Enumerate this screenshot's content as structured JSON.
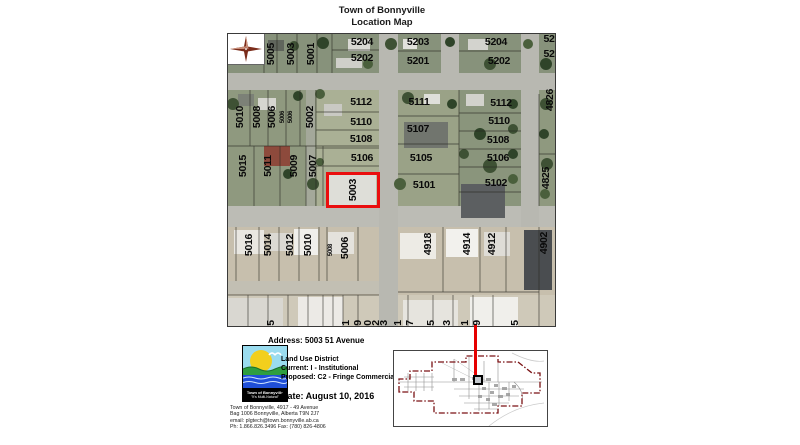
{
  "title": {
    "line1": "Town of Bonnyville",
    "line2": "Location Map"
  },
  "map": {
    "highlight": {
      "label": "5003",
      "color": "#ea0e0e"
    },
    "labels": [
      {
        "t": "5204",
        "x": 134,
        "y": 8
      },
      {
        "t": "5202",
        "x": 134,
        "y": 24
      },
      {
        "t": "5203",
        "x": 190,
        "y": 8
      },
      {
        "t": "5201",
        "x": 190,
        "y": 27
      },
      {
        "t": "5204",
        "x": 268,
        "y": 8
      },
      {
        "t": "5202",
        "x": 271,
        "y": 27
      },
      {
        "t": "52",
        "x": 321,
        "y": 5
      },
      {
        "t": "52",
        "x": 321,
        "y": 20
      },
      {
        "t": "5112",
        "x": 133,
        "y": 68
      },
      {
        "t": "5110",
        "x": 133,
        "y": 88
      },
      {
        "t": "5108",
        "x": 133,
        "y": 105
      },
      {
        "t": "5106",
        "x": 134,
        "y": 124
      },
      {
        "t": "5111",
        "x": 191,
        "y": 68
      },
      {
        "t": "5107",
        "x": 190,
        "y": 95
      },
      {
        "t": "5105",
        "x": 193,
        "y": 124
      },
      {
        "t": "5101",
        "x": 196,
        "y": 151
      },
      {
        "t": "5112",
        "x": 273,
        "y": 69
      },
      {
        "t": "5110",
        "x": 271,
        "y": 87
      },
      {
        "t": "5108",
        "x": 270,
        "y": 106
      },
      {
        "t": "5106",
        "x": 270,
        "y": 124
      },
      {
        "t": "5102",
        "x": 268,
        "y": 149
      },
      {
        "t": "5005",
        "x": 43,
        "y": 20,
        "r": 1
      },
      {
        "t": "5003",
        "x": 63,
        "y": 20,
        "r": 1
      },
      {
        "t": "5001",
        "x": 83,
        "y": 20,
        "r": 1
      },
      {
        "t": "5010",
        "x": 12,
        "y": 83,
        "r": 1
      },
      {
        "t": "5008",
        "x": 29,
        "y": 83,
        "r": 1
      },
      {
        "t": "5006",
        "x": 44,
        "y": 83,
        "r": 1
      },
      {
        "t": "5006",
        "x": 55,
        "y": 83,
        "r": 1,
        "s": 6
      },
      {
        "t": "5006",
        "x": 63,
        "y": 83,
        "r": 1,
        "s": 6
      },
      {
        "t": "5002",
        "x": 82,
        "y": 83,
        "r": 1
      },
      {
        "t": "5015",
        "x": 15,
        "y": 132,
        "r": 1
      },
      {
        "t": "5011",
        "x": 40,
        "y": 132,
        "r": 1
      },
      {
        "t": "5009",
        "x": 66,
        "y": 132,
        "r": 1
      },
      {
        "t": "5007",
        "x": 85,
        "y": 132,
        "r": 1
      },
      {
        "t": "5003",
        "x": 125,
        "y": 156,
        "r": 1
      },
      {
        "t": "5016",
        "x": 21,
        "y": 211,
        "r": 1
      },
      {
        "t": "5014",
        "x": 40,
        "y": 211,
        "r": 1
      },
      {
        "t": "5012",
        "x": 62,
        "y": 211,
        "r": 1
      },
      {
        "t": "5010",
        "x": 80,
        "y": 211,
        "r": 1
      },
      {
        "t": "5008",
        "x": 103,
        "y": 216,
        "r": 1,
        "s": 6
      },
      {
        "t": "5006",
        "x": 117,
        "y": 214,
        "r": 1
      },
      {
        "t": "4918",
        "x": 200,
        "y": 210,
        "r": 1
      },
      {
        "t": "4914",
        "x": 239,
        "y": 210,
        "r": 1
      },
      {
        "t": "4912",
        "x": 264,
        "y": 210,
        "r": 1
      },
      {
        "t": "4902",
        "x": 316,
        "y": 209,
        "r": 1
      },
      {
        "t": "4826",
        "x": 322,
        "y": 66,
        "r": 1
      },
      {
        "t": "4825",
        "x": 318,
        "y": 144,
        "r": 1
      },
      {
        "t": "5",
        "x": 43,
        "y": 289,
        "r": 1
      },
      {
        "t": "1",
        "x": 118,
        "y": 289,
        "r": 1
      },
      {
        "t": "9",
        "x": 130,
        "y": 289,
        "r": 1
      },
      {
        "t": "0",
        "x": 140,
        "y": 289,
        "r": 1
      },
      {
        "t": "2",
        "x": 148,
        "y": 289,
        "r": 1
      },
      {
        "t": "3",
        "x": 156,
        "y": 289,
        "r": 1
      },
      {
        "t": "1",
        "x": 170,
        "y": 289,
        "r": 1
      },
      {
        "t": "7",
        "x": 182,
        "y": 289,
        "r": 1
      },
      {
        "t": "5",
        "x": 203,
        "y": 289,
        "r": 1
      },
      {
        "t": "3",
        "x": 219,
        "y": 289,
        "r": 1
      },
      {
        "t": "1",
        "x": 237,
        "y": 289,
        "r": 1
      },
      {
        "t": "9",
        "x": 249,
        "y": 289,
        "r": 1
      },
      {
        "t": "5",
        "x": 287,
        "y": 289,
        "r": 1
      }
    ]
  },
  "footer": {
    "address": "Address: 5003 51 Avenue",
    "land_use": {
      "heading": "Land Use District",
      "current": "Current: I - Institutional",
      "proposed": "Proposed: C2 - Fringe Commercial"
    },
    "date": "Date: August 10, 2016",
    "contact_lines": [
      "Town of Bonnyville, 4917 - 49 Avenue",
      "Bag 1006 Bonnyville, Alberta T9N 2J7",
      "email: plgtech@town.bonnyville.ab.ca",
      "Ph: 1.866.826.3496  Fax: (780) 826-4806"
    ]
  },
  "logo": {
    "org": "Town of Bonnyville",
    "slogan": "\"It's Multi-Natural\""
  }
}
